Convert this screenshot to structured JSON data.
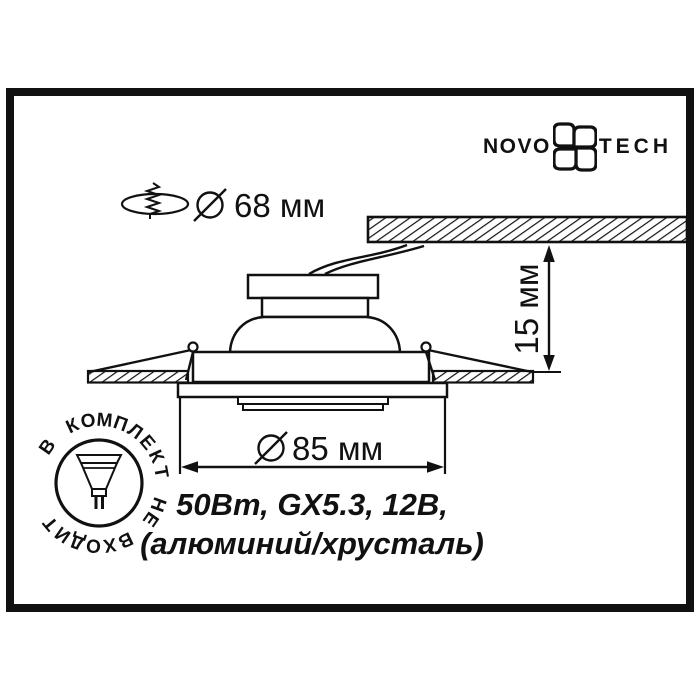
{
  "brand": {
    "left": "NOVO",
    "right": "TECH",
    "icon": "novotech-flower-icon"
  },
  "labels": {
    "cutout_diameter": "68 мм",
    "trim_diameter": "85 мм",
    "recess_height": "15 мм"
  },
  "specs": {
    "line1": "50Вт, GX5.3, 12В,",
    "line2": "(алюминий/хрусталь)"
  },
  "badge": {
    "text": "В КОМПЛЕКТ НЕ ВХОДИТ",
    "icon": "mr16-lamp-icon"
  },
  "icons": {
    "cutout": "screw-through-hole-icon",
    "diameter_symbol": "diameter-sign-icon",
    "ceiling": "hatched-ceiling-section"
  },
  "colors": {
    "ink": "#111111",
    "paper": "#ffffff"
  }
}
